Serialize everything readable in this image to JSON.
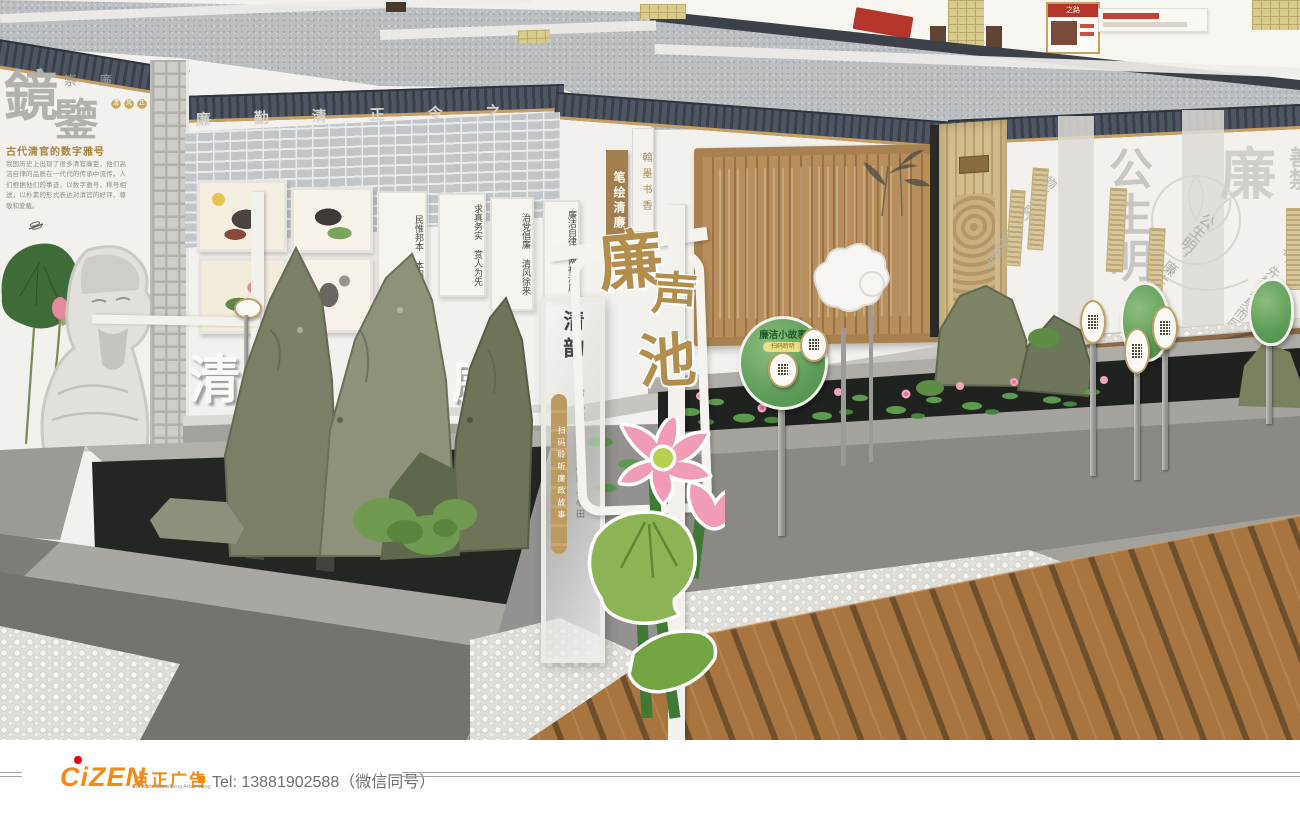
{
  "colors": {
    "accent_orange": "#f28a14",
    "logo_dot_red": "#e60012",
    "gold": "#b28d4b",
    "leaf_green": "#5c9c58",
    "roof_grey": "#4f5663",
    "water_dark": "#252823"
  },
  "scene": {
    "left_wall": {
      "big1": "鏡",
      "big2": "鑒",
      "sub": "崇 廉",
      "seals": "清风正气",
      "heading": "古代清官的数字雅号",
      "body": "我国历史上出现了很多清官廉吏，他们高洁自律的品质在一代代的传承中流传。人们根据他们的事迹，以数字雅号、称号相送，以朴素的形式表达对清官的好评、尊敬和爱戴。"
    },
    "band_chars": "廉　勤　清　正　令　之　德",
    "letters3d": {
      "a": "清",
      "b": "正",
      "c": "廉"
    },
    "scrolls": [
      "民惟邦本 本固邦宁",
      "求真务实 赏人为先",
      "治党倡廉 清风徐来",
      "廉洁自律 两袖清风"
    ],
    "center": {
      "brown_sign": "笔绘清廉",
      "medallion_sign": "翰墨书香",
      "panel_title": "清廉赋"
    },
    "glass": {
      "title": "清韵",
      "medallions": "扫码聆听廉政故事",
      "couplet": "清风拂山水 廉韵入心田"
    },
    "arch": {
      "c1": "廉",
      "c2": "声",
      "c3": "池"
    },
    "leaf_sign": {
      "header": "廉洁小故事",
      "pill": "扫码聆听"
    },
    "right_wall": {
      "big": "公生明",
      "big2": "廉",
      "big3": "善禁",
      "q1": "公生明，廉生威。",
      "q2": "善禁者，先禁其身而后人。",
      "q3": "物必先腐，而后虫生。"
    },
    "floor2": {
      "board_title": "之路"
    }
  },
  "footer": {
    "logo": "CiZEN",
    "cn": "点正广告",
    "en": "Chengdu Dianzheng Advertising",
    "tel": "Tel: 13881902588（微信同号）"
  }
}
